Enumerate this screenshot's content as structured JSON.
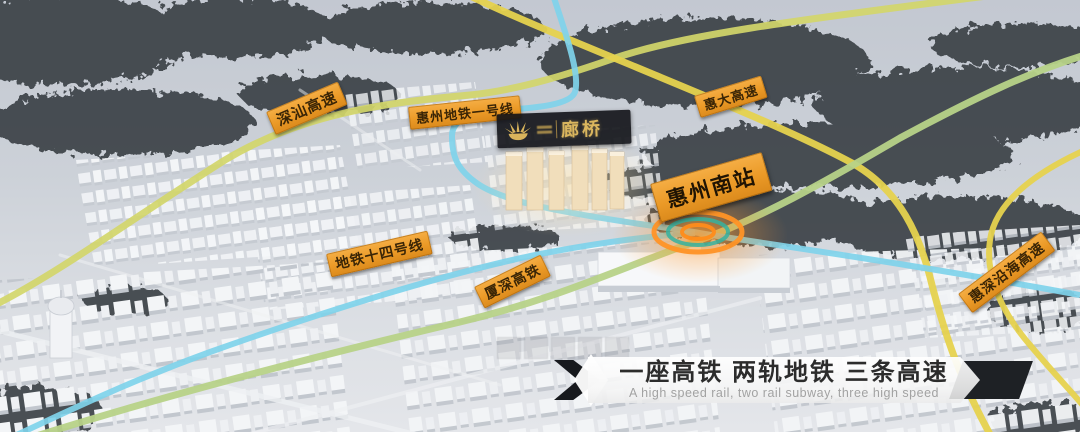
{
  "map": {
    "labels": {
      "shenshan": "深汕高速",
      "metro1": "惠州地铁一号线",
      "huida": "惠大高速",
      "station": "惠州南站",
      "metro14": "地铁十四号线",
      "xiashen": "厦深高铁",
      "coastal": "惠深沿海高速"
    },
    "project": {
      "name": "廊桥"
    },
    "colors": {
      "metro_line": "#7fd2ea",
      "high_speed_rail": "#b7d288",
      "expressway_yellow": "#e6d24e",
      "expressway_yellow_green": "#d3d66a",
      "label_orange": "#f0a43c",
      "station_glow": "#ff9326",
      "project_gold": "#d4af5e"
    }
  },
  "banner": {
    "title": "一座高铁 两轨地铁 三条高速",
    "subtitle": "A high speed rail, two rail subway, three high speed"
  }
}
